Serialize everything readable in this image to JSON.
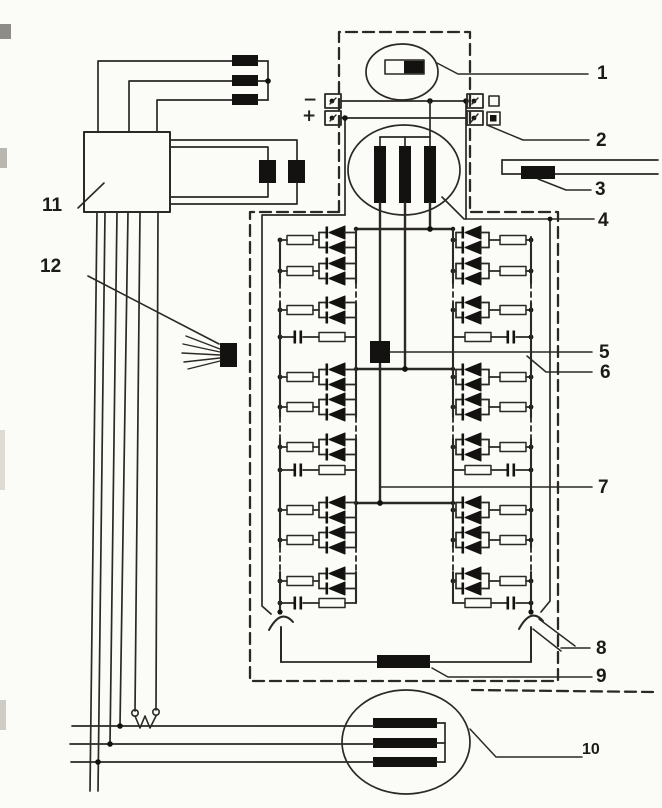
{
  "diagram": {
    "kind": "alternator-charging-system-schematic",
    "colors": {
      "line": "#2b2926",
      "component_fill": "#141210",
      "background": "#fbfbf8"
    }
  },
  "signs": {
    "minus": "−",
    "plus": "+"
  },
  "callouts": [
    "1",
    "2",
    "3",
    "4",
    "5",
    "6",
    "7",
    "8",
    "9",
    "10",
    "11",
    "12"
  ]
}
